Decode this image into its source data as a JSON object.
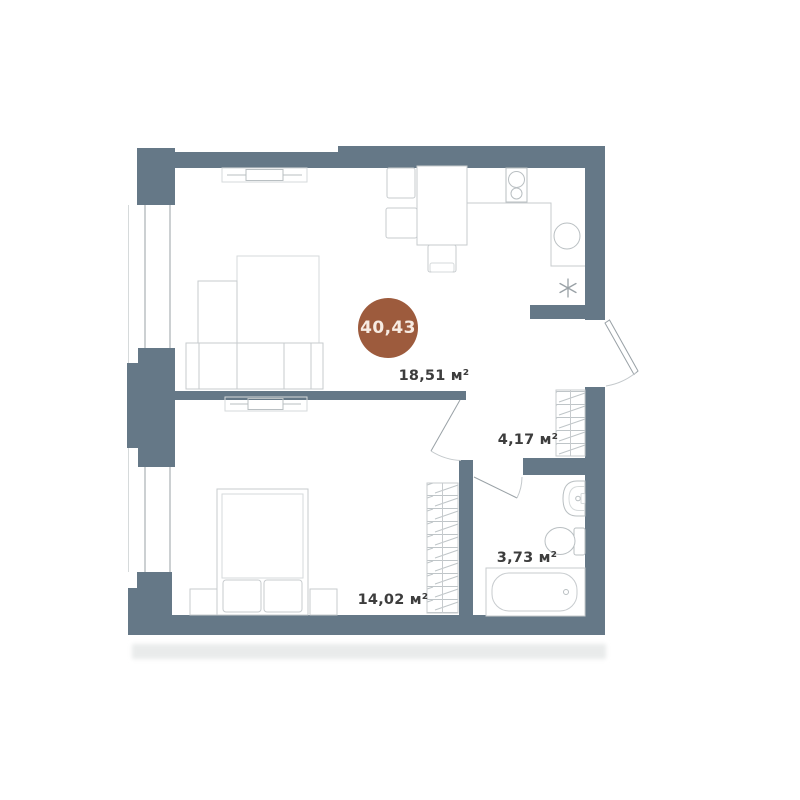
{
  "badge": {
    "total_area": "40,43"
  },
  "rooms": {
    "living_kitchen": {
      "area_label": "18,51 м²"
    },
    "hallway": {
      "area_label": "4,17 м²"
    },
    "bathroom": {
      "area_label": "3,73 м²"
    },
    "bedroom": {
      "area_label": "14,02 м²"
    }
  },
  "colors": {
    "wall": "#657887",
    "badge": "#9d5b3d",
    "badge_text": "#f7ebe2",
    "label_text": "#3d3d3d",
    "line": "#c7cbce",
    "line_mid": "#b9bfc2",
    "line_light": "#d6dadb",
    "line_dark": "#99a1a6",
    "arc": "#c3c8cb",
    "window_glass": "#b8bdc0",
    "shadow": "#e9ebeb"
  }
}
